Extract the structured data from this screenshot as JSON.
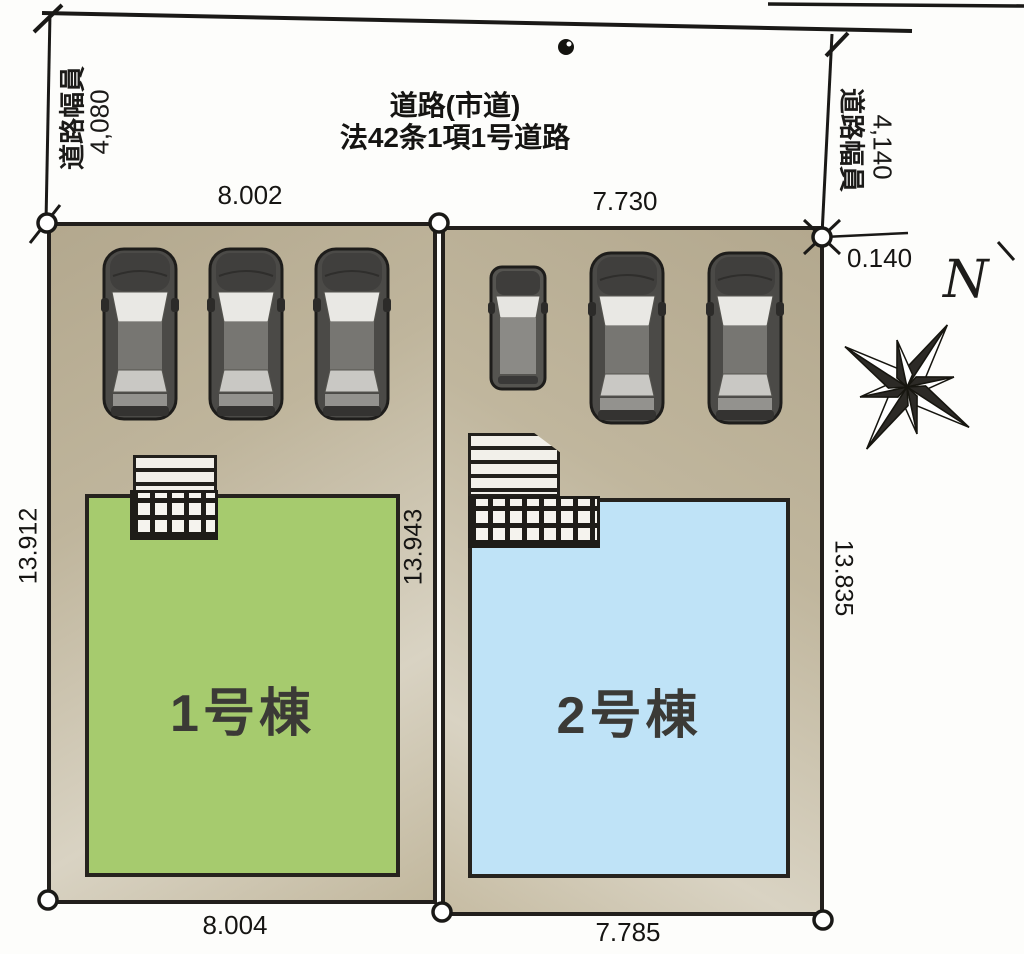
{
  "road": {
    "name_line1": "道路(市道)",
    "name_line2": "法42条1項1号道路",
    "left_width": {
      "label": "道路幅員",
      "value": "4,080"
    },
    "right_width": {
      "label": "道路幅員",
      "value": "4,140"
    },
    "corner_offset": "0.140"
  },
  "compass": {
    "north": "N"
  },
  "divider": {
    "side_dim": "13.943"
  },
  "lots": [
    {
      "building": "1号棟",
      "building_color": "#a6cb6e",
      "top_dim": "8.002",
      "bottom_dim": "8.004",
      "side_dim": "13.912",
      "cars": [
        "sedan",
        "sedan",
        "sedan"
      ]
    },
    {
      "building": "2号棟",
      "building_color": "#bfe3f7",
      "top_dim": "7.730",
      "bottom_dim": "7.785",
      "side_dim": "13.835",
      "cars": [
        "wagon",
        "sedan",
        "sedan"
      ]
    }
  ],
  "colors": {
    "ground": "#bdb299",
    "outline": "#221f1c",
    "lot1_building": "#a6cb6e",
    "lot2_building": "#bfe3f7"
  }
}
